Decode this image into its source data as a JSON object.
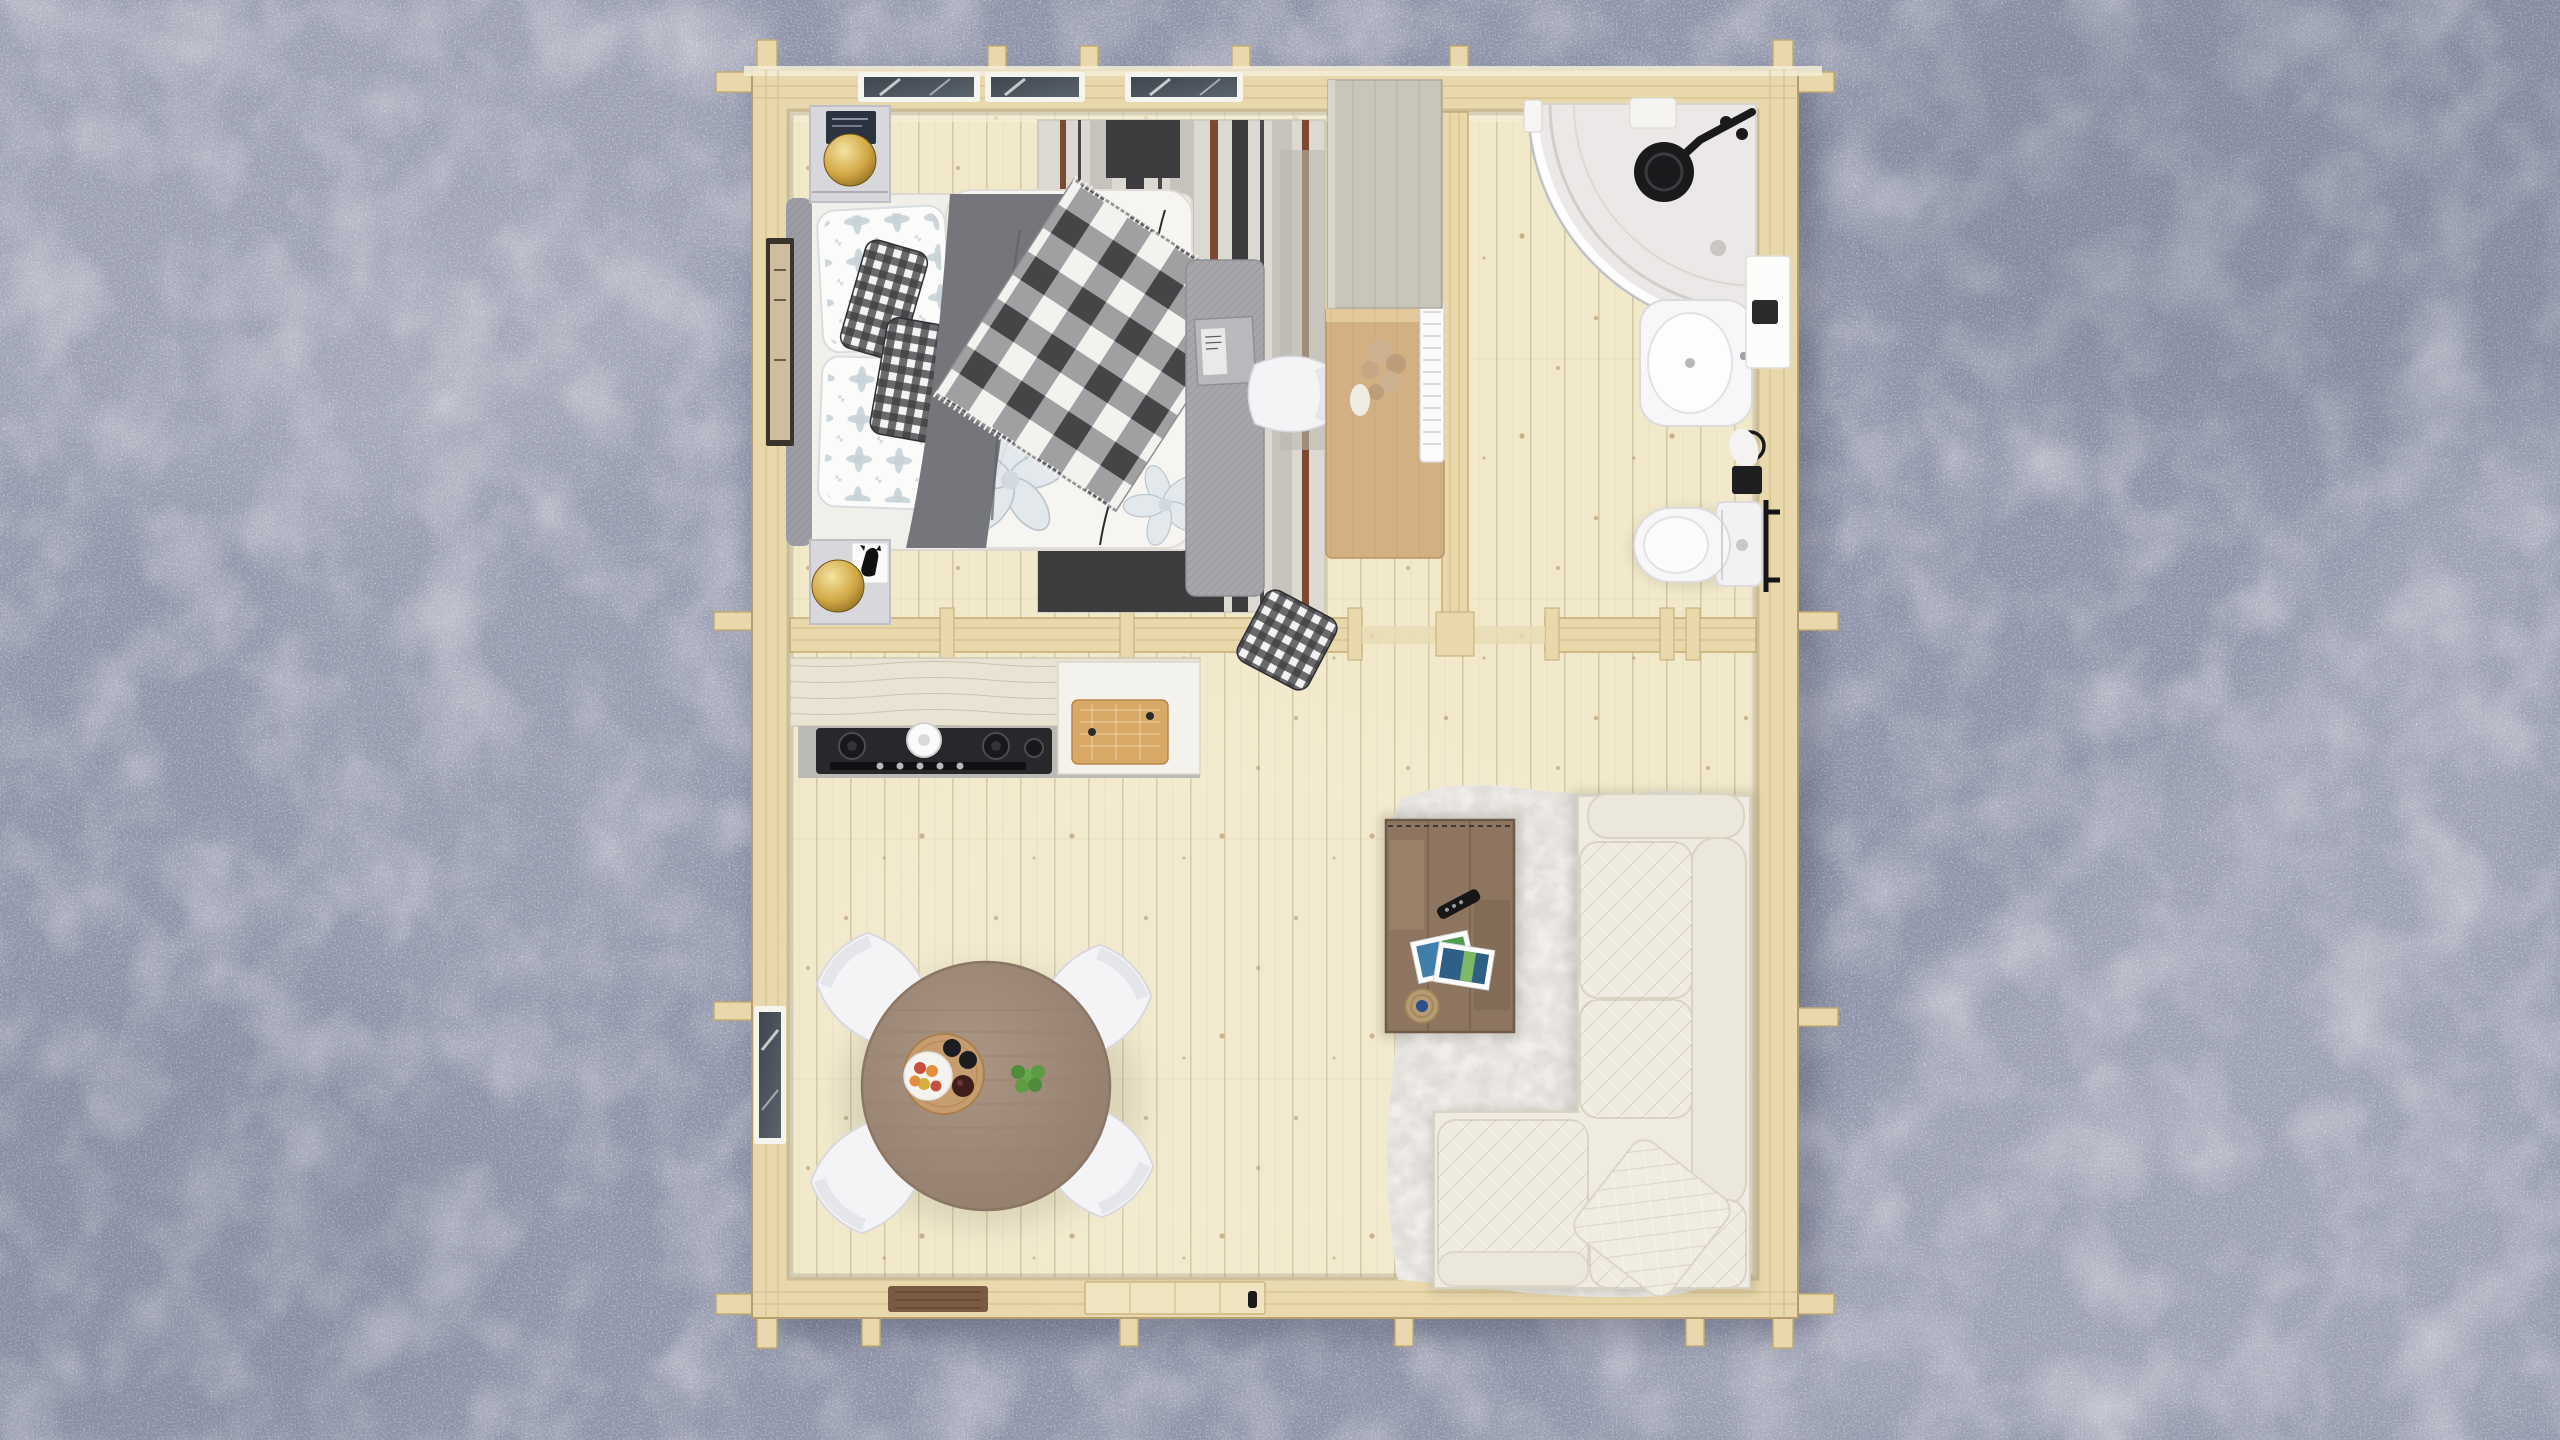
{
  "scene": {
    "type": "3D architectural render, top-down plan view",
    "subject": "One-bedroom log cabin floor plan with full furnishing",
    "surroundings": "blue-gray gravel ground with soft sunlight streaks",
    "camera": "bird's eye view"
  },
  "building": {
    "structure": "log cabin with protruding corner log joints",
    "rooms": [
      "bedroom",
      "bathroom",
      "kitchen",
      "dining area",
      "living area"
    ]
  },
  "rooms": {
    "bedroom": {
      "label": "Bedroom",
      "items": [
        "double bed with gray blanket and plaid throw",
        "patterned pillows",
        "gingham cushions",
        "two nightstands",
        "two brass dome lamps",
        "navy book",
        "cat figurine card",
        "striped area rug",
        "gray fabric bench with book",
        "framed wall art",
        "desk with dried flowers",
        "white desk chair",
        "gray-washed wardrobe",
        "white radiator"
      ]
    },
    "bathroom": {
      "label": "Bathroom",
      "items": [
        "corner shower with curved glass",
        "black rain shower head",
        "washbasin with chrome faucet",
        "white vanity shelf",
        "wall box",
        "towel ring with towel",
        "toilet with cistern",
        "black grab bar"
      ]
    },
    "kitchen": {
      "label": "Kitchen",
      "items": [
        "whitewashed counter",
        "gray worktop",
        "gas cooktop with control knobs",
        "white pot",
        "wooden cutting board"
      ]
    },
    "dining": {
      "label": "Dining area",
      "items": [
        "round wooden table",
        "four white shell chairs",
        "serving tray",
        "fruit plate",
        "dark cups",
        "green plant"
      ]
    },
    "living": {
      "label": "Living area",
      "items": [
        "white fur rug",
        "rustic plank coffee table",
        "remote control",
        "photo prints",
        "jute coaster",
        "cream L-shaped quilted sofa",
        "throw pillow"
      ],
      "extras": [
        "entrance door with black handle",
        "brown doormat"
      ]
    }
  },
  "colors": {
    "gravel": "#8f94a8",
    "wall_wood": "#e9d8ab",
    "floor_wood": "#f2e9cb",
    "window_glass": "#454d56",
    "window_frame": "#f6f4ee",
    "door_leaf": "#efe4bf",
    "door_mat": "#7a5a42",
    "rug_base": "#dcd9d3",
    "rug_charcoal": "#3d3c3e",
    "rug_brown": "#7b4a31",
    "headboard": "#9c9da4",
    "mattress": "#f1efe9",
    "blanket": "#75767c",
    "duvet": "#f7f5f1",
    "bench": "#a7a7ab",
    "nightstand": "#d8d8dc",
    "book_navy": "#2c3340",
    "wardrobe": "#c8c5bb",
    "desk": "#d2b083",
    "chair": "#f4f4f6",
    "counter_wood": "#e8e3d3",
    "worktop": "#bcbab6",
    "cooktop": "#26282b",
    "board": "#d9a966",
    "table": "#a08a78",
    "tray": "#c59d6e",
    "plant": "#67a84a",
    "shower_tray": "#ebe8e7",
    "porcelain": "#f7f6f8",
    "fixture": "#1a1a1c",
    "fur": "#f1efec",
    "coffee_table": "#8d7560",
    "sofa": "#efebe0",
    "sofa_cushion": "#ece7db",
    "remote": "#161616",
    "brass": "#d1a845"
  }
}
